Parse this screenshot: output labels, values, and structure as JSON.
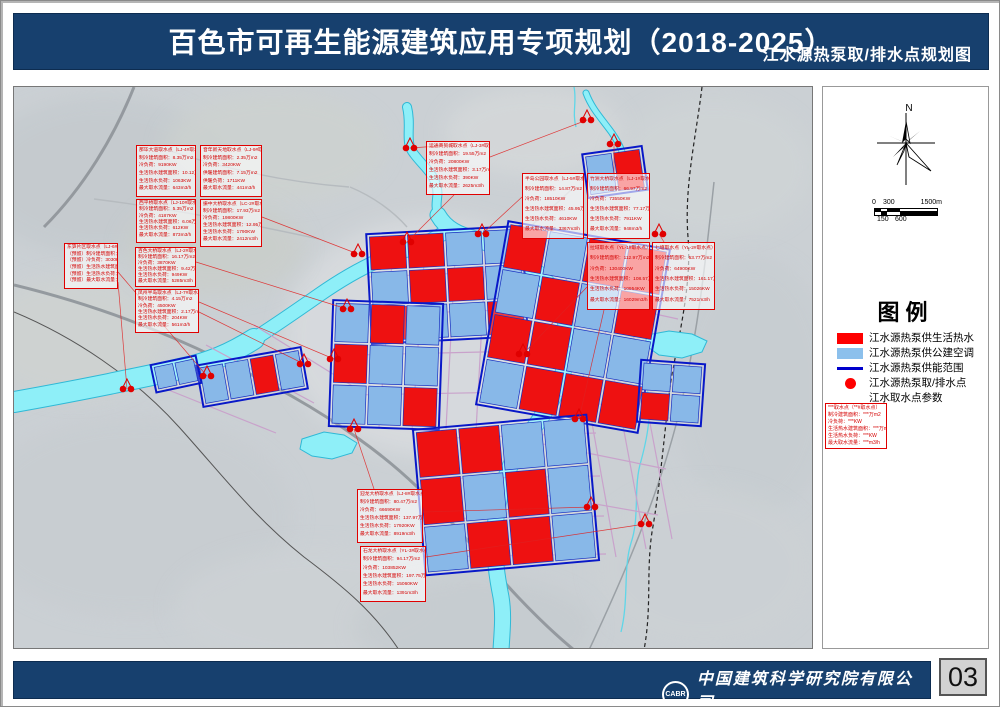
{
  "title_bar": {
    "title": "百色市可再生能源建筑应用专项规划（2018-2025）",
    "subtitle": "江水源热泵取/排水点规划图"
  },
  "sidebar": {
    "north_label": "N",
    "scale": {
      "zero": "0",
      "mid": "300",
      "max": "1500m",
      "b1": "150",
      "b2": "600"
    },
    "legend_title": "图例",
    "items": [
      {
        "swatch": "red-rect",
        "label": "江水源热泵供生活热水"
      },
      {
        "swatch": "blue-rect",
        "label": "江水源热泵供公建空调"
      },
      {
        "swatch": "blue-line",
        "label": "江水源热泵供能范围"
      },
      {
        "swatch": "red-dot",
        "label": "江水源热泵取/排水点"
      },
      {
        "swatch": "param-box",
        "label": "江水取水点参数"
      }
    ],
    "param_sample": [
      "***取水点（**#取水点）",
      "制冷建筑面积：***万m2",
      "冷负荷：***KW",
      "生活热水建筑面积：***万m2",
      "生活热水负荷：***KW",
      "最大取水流量：***m3/h"
    ]
  },
  "footer": {
    "logo_text": "CABR",
    "company_cn": "中国建筑科学研究院有限公司",
    "company_en": "China Academy of Building Research",
    "page_number": "03"
  },
  "colors": {
    "navy": "#17406e",
    "parcel_red": "#ee1111",
    "parcel_blue": "#88b8e8",
    "bound_blue": "#0818c8",
    "river_fill": "#8eeff8",
    "river_edge": "#2fb9d6",
    "anno_red": "#e00000",
    "road_pink": "#c9a2cb",
    "road_gray": "#8e9499"
  },
  "map": {
    "terrain": [
      {
        "cx": 90,
        "cy": 90,
        "rx": 130,
        "ry": 80,
        "f": "#c3c9cd"
      },
      {
        "cx": 260,
        "cy": 60,
        "rx": 110,
        "ry": 55,
        "f": "#cdd2cf"
      },
      {
        "cx": 520,
        "cy": 45,
        "rx": 90,
        "ry": 45,
        "f": "#d6d9da"
      },
      {
        "cx": 700,
        "cy": 80,
        "rx": 100,
        "ry": 70,
        "f": "#cfd4d6"
      },
      {
        "cx": 740,
        "cy": 300,
        "rx": 80,
        "ry": 130,
        "f": "#c6ccd0"
      },
      {
        "cx": 690,
        "cy": 480,
        "rx": 110,
        "ry": 80,
        "f": "#ccd1d4"
      },
      {
        "cx": 420,
        "cy": 250,
        "rx": 150,
        "ry": 120,
        "f": "#dadde0"
      },
      {
        "cx": 120,
        "cy": 430,
        "rx": 160,
        "ry": 100,
        "f": "#c7ccd0"
      },
      {
        "cx": 300,
        "cy": 520,
        "rx": 140,
        "ry": 60,
        "f": "#cdd2d5"
      },
      {
        "cx": 60,
        "cy": 250,
        "rx": 90,
        "ry": 60,
        "f": "#cfd3d0"
      },
      {
        "cx": 200,
        "cy": 160,
        "rx": 90,
        "ry": 50,
        "f": "#c9cec9"
      },
      {
        "cx": 460,
        "cy": 540,
        "rx": 120,
        "ry": 50,
        "f": "#c5cbcf"
      }
    ],
    "minor_roads": [
      "M150,62 C210,82 270,95 335,100",
      "M80,112 C160,122 230,136 305,152",
      "M336,100 C360,110 380,125 393,140",
      "M560,100 C540,120 520,135 505,150"
    ],
    "highways": [
      "M0,198 C70,215 140,240 205,272 C260,298 300,320 345,352 C390,384 420,415 455,455 C485,490 520,530 560,563",
      "M120,0 C100,50 70,100 30,140"
    ],
    "side_road": "M700,95 C692,170 684,250 664,330 C646,402 615,478 575,563",
    "railway": "M0,225 C60,250 120,290 165,340 C210,390 240,430 290,470 C330,500 360,525 385,563",
    "dashed_boundary": "M688,0 C682,50 670,100 674,150 C678,200 664,250 656,300 C650,350 646,400 638,445 C632,485 638,520 630,563",
    "pink_roads": [
      "M380,150 L365,340",
      "M412,148 L398,344",
      "M442,152 L432,342",
      "M472,162 L462,344",
      "M355,190 L520,183",
      "M350,228 L516,222",
      "M342,268 L512,264",
      "M336,308 L506,305",
      "M545,152 L602,470",
      "M576,162 L632,462",
      "M606,178 L658,452",
      "M540,205 L664,232",
      "M533,255 L666,283",
      "M526,305 L660,332",
      "M519,355 L652,382",
      "M513,405 L644,428",
      "M408,352 L582,346",
      "M405,392 L586,389",
      "M410,432 L590,429",
      "M416,470 L592,467",
      "M192,258 L300,316",
      "M152,302 L262,346",
      "M240,238 L340,300"
    ],
    "rivers": [
      {
        "d": "M424,128 C432,142 445,148 462,152 C490,162 510,172 528,190 C545,208 552,225 553,250 C554,275 548,295 535,318 C522,340 505,358 495,382 C487,402 482,420 481,445 C480,470 483,490 487,510 C490,528 488,545 487,563",
        "w": 15
      },
      {
        "d": "M393,20 C398,40 390,55 400,67 C410,80 418,85 422,98 C426,108 420,115 424,128",
        "w": 8
      },
      {
        "d": "M430,146 C410,158 390,164 368,172 C345,182 325,194 305,208 C285,222 262,238 240,252",
        "w": 13
      },
      {
        "d": "M240,252 C218,266 195,276 170,281 C145,287 118,292 95,297 C70,302 40,308 0,315",
        "w": 20
      },
      {
        "d": "M572,6 C578,22 588,32 598,46 C606,58 612,68 608,82",
        "w": 5
      }
    ],
    "streams": [
      "M630,290 C640,318 634,348 627,374 C619,400 626,430 617,456 C609,482 615,512 607,545",
      "M560,0 C563,14 558,26 562,40"
    ],
    "lakes": [
      "288,352 310,345 330,348 343,356 338,366 318,372 298,369 286,362",
      "633,248 655,244 678,247 693,254 688,265 668,271 645,268 631,258"
    ],
    "clusters": [
      {
        "x": 358,
        "y": 146,
        "w": 150,
        "h": 104,
        "rot": -3,
        "grid": [
          [
            "r",
            "r",
            "b",
            "b"
          ],
          [
            "b",
            "r",
            "r",
            "b"
          ],
          [
            "r",
            "b",
            "b",
            "r"
          ]
        ]
      },
      {
        "x": 480,
        "y": 150,
        "w": 158,
        "h": 180,
        "rot": 10,
        "grid": [
          [
            "r",
            "b",
            "r",
            "r"
          ],
          [
            "b",
            "r",
            "b",
            "r"
          ],
          [
            "r",
            "r",
            "b",
            "b"
          ],
          [
            "b",
            "r",
            "r",
            "r"
          ]
        ]
      },
      {
        "x": 320,
        "y": 218,
        "w": 104,
        "h": 120,
        "rot": 2,
        "grid": [
          [
            "b",
            "r",
            "b"
          ],
          [
            "r",
            "b",
            "b"
          ],
          [
            "b",
            "b",
            "r"
          ]
        ]
      },
      {
        "x": 408,
        "y": 338,
        "w": 168,
        "h": 140,
        "rot": -5,
        "grid": [
          [
            "r",
            "r",
            "b",
            "b"
          ],
          [
            "r",
            "b",
            "r",
            "b"
          ],
          [
            "b",
            "r",
            "r",
            "b"
          ]
        ]
      },
      {
        "x": 188,
        "y": 272,
        "w": 100,
        "h": 36,
        "rot": -10,
        "grid": [
          [
            "b",
            "b",
            "r",
            "b"
          ]
        ]
      },
      {
        "x": 574,
        "y": 66,
        "w": 54,
        "h": 38,
        "rot": -8,
        "grid": [
          [
            "b",
            "r"
          ]
        ]
      },
      {
        "x": 628,
        "y": 278,
        "w": 58,
        "h": 56,
        "rot": 4,
        "grid": [
          [
            "b",
            "b"
          ],
          [
            "r",
            "b"
          ]
        ]
      },
      {
        "x": 142,
        "y": 276,
        "w": 40,
        "h": 22,
        "rot": -12,
        "grid": [
          [
            "b",
            "b"
          ]
        ]
      }
    ],
    "markers": [
      [
        396,
        61
      ],
      [
        573,
        33
      ],
      [
        600,
        57
      ],
      [
        468,
        147
      ],
      [
        393,
        155
      ],
      [
        344,
        167
      ],
      [
        333,
        222
      ],
      [
        320,
        272
      ],
      [
        290,
        277
      ],
      [
        193,
        289
      ],
      [
        113,
        302
      ],
      [
        645,
        147
      ],
      [
        509,
        267
      ],
      [
        565,
        332
      ],
      [
        577,
        420
      ],
      [
        631,
        437
      ],
      [
        340,
        342
      ]
    ],
    "leaders": [
      [
        396,
        61,
        440,
        58
      ],
      [
        393,
        155,
        440,
        108
      ],
      [
        468,
        147,
        508,
        110
      ],
      [
        344,
        167,
        248,
        130
      ],
      [
        333,
        222,
        182,
        175
      ],
      [
        320,
        272,
        185,
        215
      ],
      [
        290,
        277,
        185,
        225
      ],
      [
        193,
        289,
        104,
        185
      ],
      [
        113,
        302,
        104,
        195
      ],
      [
        573,
        33,
        476,
        70
      ],
      [
        600,
        57,
        600,
        86
      ],
      [
        645,
        147,
        650,
        155
      ],
      [
        509,
        267,
        573,
        200
      ],
      [
        565,
        332,
        590,
        223
      ],
      [
        577,
        420,
        409,
        425
      ],
      [
        631,
        437,
        412,
        470
      ],
      [
        340,
        342,
        360,
        402
      ]
    ],
    "annotations": [
      {
        "x": 122,
        "y": 58,
        "w": 60,
        "h": 52,
        "title": "那毕大道取水点（LJ-4#取水点）",
        "lines": [
          "制冷建筑面积：8.35万m2",
          "冷负荷：9190KW",
          "生活热水建筑面积：10.12万m2",
          "生活热水负荷：1063KW",
          "最大取水流量：643m3/h"
        ]
      },
      {
        "x": 186,
        "y": 58,
        "w": 62,
        "h": 52,
        "title": "音年新天地取水点（LJ-9#取水点）",
        "lines": [
          "制冷建筑面积：2.35万m2",
          "冷负荷：3420KW",
          "供暖建筑面积：7.15万m2",
          "供暖负荷：1711KW",
          "最大取水流量：441m3/h"
        ]
      },
      {
        "x": 122,
        "y": 112,
        "w": 60,
        "h": 44,
        "title": "西平桥取水点（LJ-10#取水点）",
        "lines": [
          "制冷建筑面积：5.35万m2",
          "冷负荷：4187KW",
          "生活热水建筑面积：6.06万m2",
          "生活热水负荷：612KW",
          "最大取水流量：873m3/h"
        ]
      },
      {
        "x": 186,
        "y": 112,
        "w": 62,
        "h": 48,
        "title": "振中大桥取水点（LC-2#取水点）",
        "lines": [
          "制冷建筑面积：17.93万m2",
          "冷负荷：19800KW",
          "生活热水建筑面积：12.95万m2",
          "生活热水负荷：1790KW",
          "最大取水流量：2412m3/h"
        ]
      },
      {
        "x": 50,
        "y": 156,
        "w": 54,
        "h": 46,
        "title": "东笋片区取水点（LJ-6#取水点）（预留）",
        "lines": [
          "（预留）制冷建筑面积：9.25万m2",
          "（预留）冷负荷：3030KW",
          "（预留）生活热水建筑面积：1.97万m2",
          "（预留）生活热水负荷：2000KW",
          "（预留）最大取水流量：4540m3/h"
        ]
      },
      {
        "x": 121,
        "y": 160,
        "w": 61,
        "h": 40,
        "title": "百色大桥取水点（LJ-2#取水点）",
        "lines": [
          "制冷建筑面积：16.17万m2",
          "冷负荷：3870KW",
          "生活热水建筑面积：9.42万m2",
          "生活热水负荷：949KW",
          "最大取水流量：5285m3/h"
        ]
      },
      {
        "x": 121,
        "y": 202,
        "w": 64,
        "h": 44,
        "title": "凤州半岛取水点（LJ-7#取水点）",
        "lines": [
          "制冷建筑面积：4.15万m2",
          "冷负荷：4500KW",
          "生活热水建筑面积：2.17万m2",
          "生活热水负荷：204KW",
          "最大取水流量：561m3/h"
        ]
      },
      {
        "x": 412,
        "y": 54,
        "w": 64,
        "h": 54,
        "title": "运通商贸城取水点（LJ-3#取水点）",
        "lines": [
          "制冷建筑面积：19.55万m2",
          "冷负荷：20800KW",
          "生活热水建筑面积：3.17万m2",
          "生活热水负荷：390KW",
          "最大取水流量：2625m3/h"
        ]
      },
      {
        "x": 508,
        "y": 86,
        "w": 62,
        "h": 66,
        "title": "半岛公园取水点（LJ-5#取水点）",
        "lines": [
          "制冷建筑面积：14.87万m2",
          "冷负荷：18510KW",
          "生活热水建筑面积：45.95万m2",
          "生活热水负荷：4610KW",
          "最大取水流量：3367m3/h"
        ]
      },
      {
        "x": 573,
        "y": 86,
        "w": 63,
        "h": 66,
        "title": "竹洲大桥取水点（LJ-1#取水点）",
        "lines": [
          "制冷建筑面积：66.97万m2",
          "冷负荷：73550KW",
          "生活热水建筑面积：77.17万m2",
          "生活热水负荷：7911KW",
          "最大取水流量：948m3/h"
        ]
      },
      {
        "x": 573,
        "y": 155,
        "w": 63,
        "h": 68,
        "title": "拉域取水点（YL-1#取水点）",
        "lines": [
          "制冷建筑面积：112.97万m2",
          "冷负荷：130400KW",
          "生活热水建筑面积：108.57万m2",
          "生活热水负荷：10954KW",
          "最大取水流量：16029m3/h"
        ]
      },
      {
        "x": 638,
        "y": 155,
        "w": 63,
        "h": 68,
        "title": "七塘取水点（YL-2#取水点）",
        "lines": [
          "制冷建筑面积：53.77万m2",
          "冷负荷：64900KW",
          "生活热水建筑面积：161.17万m2",
          "生活热水负荷：15026KW",
          "最大取水流量：7521m3/h"
        ]
      },
      {
        "x": 343,
        "y": 402,
        "w": 66,
        "h": 54,
        "title": "迎龙大桥取水点（LJ-8#取水点）",
        "lines": [
          "制冷建筑面积：80.47万m2",
          "冷负荷：66690KW",
          "生活热水建筑面积：137.97万m2",
          "生活热水负荷：17920KW",
          "最大取水流量：8919m3/h"
        ]
      },
      {
        "x": 346,
        "y": 459,
        "w": 66,
        "h": 56,
        "title": "石龙大桥取水点（YL-3#取水点）",
        "lines": [
          "制冷建筑面积：94.17万m2",
          "冷负荷：103852KW",
          "生活热水建筑面积：197.75万m2",
          "生活热水负荷：15060KW",
          "最大取水流量：1391m3/h"
        ]
      }
    ]
  }
}
